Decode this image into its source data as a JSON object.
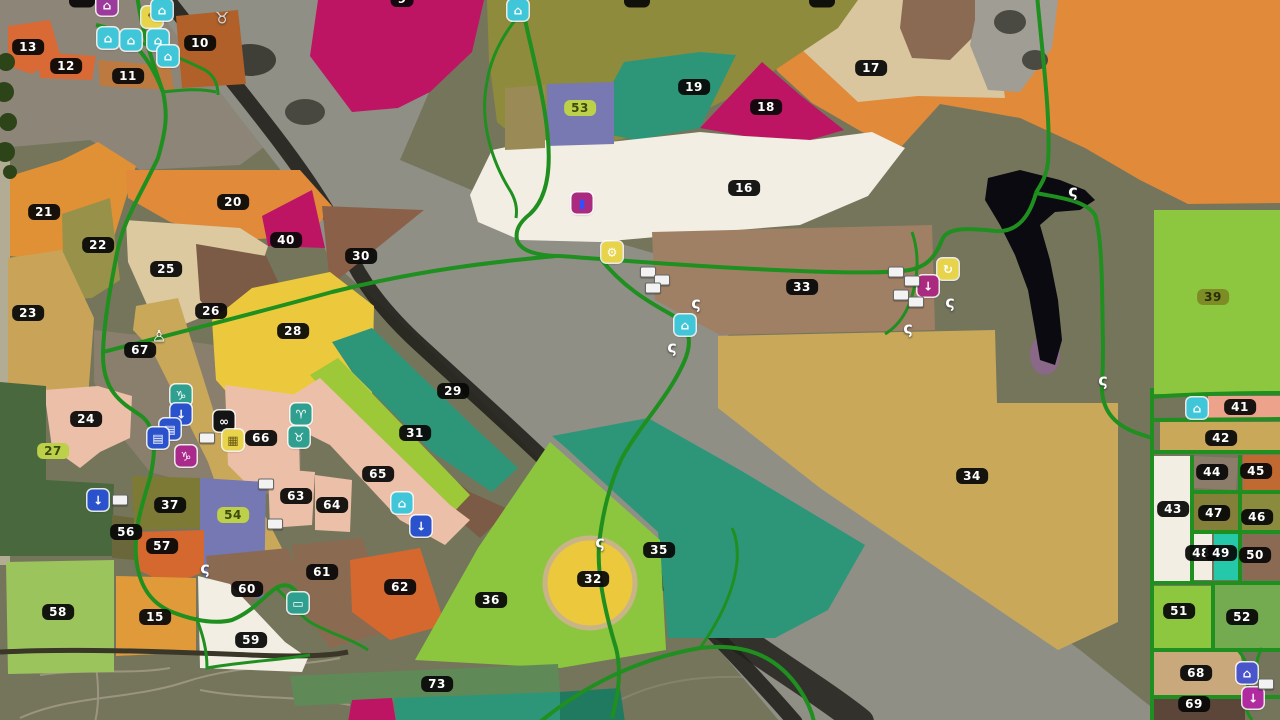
{
  "map": {
    "title": "farm-map-overview",
    "road_color": "#1f8f1f",
    "river_color": "#8f8f86",
    "river_dark_color": "#22211c",
    "lake_color": "#0a0a10",
    "terrain_color": "#75755c",
    "label_styles": {
      "dark": {
        "bg": "#0a0a0a",
        "fg": "#ffffff"
      },
      "green": {
        "bg": "#bdd04a",
        "fg": "#3c4a0c"
      },
      "olive": {
        "bg": "#7d8c24",
        "fg": "#272f08"
      }
    },
    "fields": [
      {
        "n": "9",
        "x": 402,
        "y": -1,
        "c": "#be1464"
      },
      {
        "n": "10",
        "x": 200,
        "y": 43,
        "c": "#b06028"
      },
      {
        "n": "11",
        "x": 128,
        "y": 76,
        "c": "#bd7a40"
      },
      {
        "n": "12",
        "x": 66,
        "y": 66,
        "c": "#d96a35"
      },
      {
        "n": "13",
        "x": 28,
        "y": 47,
        "c": "#d96a35"
      },
      {
        "n": "15",
        "x": 155,
        "y": 617,
        "c": "#e09a3a"
      },
      {
        "n": "16",
        "x": 744,
        "y": 188,
        "c": "#f2eee3"
      },
      {
        "n": "17",
        "x": 871,
        "y": 68,
        "c": "#e08a3a"
      },
      {
        "n": "18",
        "x": 766,
        "y": 107,
        "c": "#be1464"
      },
      {
        "n": "19",
        "x": 694,
        "y": 87,
        "c": "#2e9678"
      },
      {
        "n": "20",
        "x": 233,
        "y": 202,
        "c": "#e08a3a"
      },
      {
        "n": "21",
        "x": 44,
        "y": 212,
        "c": "#e09035"
      },
      {
        "n": "22",
        "x": 98,
        "y": 245,
        "c": "#97914a"
      },
      {
        "n": "23",
        "x": 28,
        "y": 313,
        "c": "#c9a458"
      },
      {
        "n": "24",
        "x": 86,
        "y": 419,
        "c": "#ecbfa8"
      },
      {
        "n": "25",
        "x": 166,
        "y": 269,
        "c": "#dcc9a0"
      },
      {
        "n": "26",
        "x": 211,
        "y": 311,
        "c": "#7b5a46"
      },
      {
        "n": "27",
        "x": 53,
        "y": 451,
        "c": "#4a683e",
        "s": "green"
      },
      {
        "n": "28",
        "x": 293,
        "y": 331,
        "c": "#ecc93c"
      },
      {
        "n": "29",
        "x": 453,
        "y": 391,
        "c": "#2e9678"
      },
      {
        "n": "30",
        "x": 361,
        "y": 256,
        "c": "#8a6148"
      },
      {
        "n": "31",
        "x": 415,
        "y": 433,
        "c": "#9dc838"
      },
      {
        "n": "32",
        "x": 593,
        "y": 579,
        "c": "#ecc93c"
      },
      {
        "n": "33",
        "x": 802,
        "y": 287,
        "c": "#a08065"
      },
      {
        "n": "34",
        "x": 972,
        "y": 476,
        "c": "#c9a85a"
      },
      {
        "n": "35",
        "x": 659,
        "y": 550,
        "c": "#2e9678"
      },
      {
        "n": "36",
        "x": 491,
        "y": 600,
        "c": "#8cc63f"
      },
      {
        "n": "37",
        "x": 170,
        "y": 505,
        "c": "#7d7a35"
      },
      {
        "n": "39",
        "x": 1213,
        "y": 297,
        "c": "#8dc63f",
        "s": "olive"
      },
      {
        "n": "40",
        "x": 286,
        "y": 240,
        "c": "#be1464"
      },
      {
        "n": "41",
        "x": 1240,
        "y": 407,
        "c": "#eda28c"
      },
      {
        "n": "42",
        "x": 1221,
        "y": 438,
        "c": "#c9a85a"
      },
      {
        "n": "43",
        "x": 1173,
        "y": 509,
        "c": "#f2eee3"
      },
      {
        "n": "44",
        "x": 1212,
        "y": 472,
        "c": "#8c7c6a"
      },
      {
        "n": "45",
        "x": 1256,
        "y": 471,
        "c": "#c06a32"
      },
      {
        "n": "46",
        "x": 1257,
        "y": 517,
        "c": "#8b8b3d"
      },
      {
        "n": "47",
        "x": 1214,
        "y": 513,
        "c": "#84803a"
      },
      {
        "n": "48",
        "x": 1201,
        "y": 553,
        "c": "#f2eee3"
      },
      {
        "n": "49",
        "x": 1221,
        "y": 553,
        "c": "#25c8a8"
      },
      {
        "n": "50",
        "x": 1255,
        "y": 555,
        "c": "#8a6a52"
      },
      {
        "n": "51",
        "x": 1179,
        "y": 611,
        "c": "#8dc63f"
      },
      {
        "n": "52",
        "x": 1242,
        "y": 617,
        "c": "#74ab50"
      },
      {
        "n": "53",
        "x": 580,
        "y": 108,
        "c": "#7878b2",
        "s": "green"
      },
      {
        "n": "54",
        "x": 233,
        "y": 515,
        "c": "#7578b2",
        "s": "green"
      },
      {
        "n": "56",
        "x": 126,
        "y": 532,
        "c": "#6a683a"
      },
      {
        "n": "57",
        "x": 162,
        "y": 546,
        "c": "#d4682f"
      },
      {
        "n": "58",
        "x": 58,
        "y": 612,
        "c": "#9cc45c"
      },
      {
        "n": "59",
        "x": 251,
        "y": 640,
        "c": "#f2eee3"
      },
      {
        "n": "60",
        "x": 247,
        "y": 589,
        "c": "#8b6a52"
      },
      {
        "n": "61",
        "x": 322,
        "y": 572,
        "c": "#8b6a52"
      },
      {
        "n": "62",
        "x": 400,
        "y": 587,
        "c": "#d4682f"
      },
      {
        "n": "63",
        "x": 296,
        "y": 496,
        "c": "#ecbfa8"
      },
      {
        "n": "64",
        "x": 332,
        "y": 505,
        "c": "#ecbfa8"
      },
      {
        "n": "65",
        "x": 378,
        "y": 474,
        "c": "#ecbfa8"
      },
      {
        "n": "66",
        "x": 261,
        "y": 438,
        "c": "#ecbfa8"
      },
      {
        "n": "67",
        "x": 140,
        "y": 350,
        "c": "#c9a85a"
      },
      {
        "n": "68",
        "x": 1196,
        "y": 673,
        "c": "#c9a87c"
      },
      {
        "n": "69",
        "x": 1194,
        "y": 704,
        "c": "#5c463a"
      },
      {
        "n": "73",
        "x": 437,
        "y": 684,
        "c": "#5f8a57"
      }
    ],
    "cut_labels": [
      {
        "x": 82,
        "y": 0,
        "t": ""
      },
      {
        "x": 637,
        "y": 0,
        "t": ""
      },
      {
        "x": 822,
        "y": 0,
        "t": ""
      }
    ],
    "icons": [
      {
        "name": "purple-building-icon",
        "k": "sq",
        "x": 107,
        "y": 5,
        "bg": "#9b3a9b",
        "fg": "#ffffff",
        "g": "⌂"
      },
      {
        "name": "notebook-icon",
        "k": "sq",
        "x": 152,
        "y": 17,
        "bg": "#e8d44a",
        "fg": "#5a4a10",
        "g": "✎"
      },
      {
        "name": "greenhouse-icon",
        "k": "sq",
        "x": 162,
        "y": 10,
        "bg": "#3fc6d9",
        "fg": "#ffffff",
        "g": "⌂"
      },
      {
        "name": "greenhouse-icon",
        "k": "sq",
        "x": 108,
        "y": 38,
        "bg": "#3fc6d9",
        "fg": "#ffffff",
        "g": "⌂"
      },
      {
        "name": "greenhouse-icon",
        "k": "sq",
        "x": 131,
        "y": 40,
        "bg": "#3fc6d9",
        "fg": "#ffffff",
        "g": "⌂"
      },
      {
        "name": "greenhouse-icon",
        "k": "sq",
        "x": 158,
        "y": 40,
        "bg": "#3fc6d9",
        "fg": "#ffffff",
        "g": "⌂"
      },
      {
        "name": "greenhouse-icon",
        "k": "sq",
        "x": 168,
        "y": 56,
        "bg": "#3fc6d9",
        "fg": "#ffffff",
        "g": "⌂"
      },
      {
        "name": "cow-icon",
        "k": "pin",
        "x": 222,
        "y": 18,
        "fg": "#d8d8d8",
        "g": "♉"
      },
      {
        "name": "greenhouse-icon",
        "k": "sq",
        "x": 518,
        "y": 10,
        "bg": "#3fc6d9",
        "fg": "#ffffff",
        "g": "⌂"
      },
      {
        "name": "fuel-station-icon",
        "k": "sq",
        "x": 582,
        "y": 203,
        "bg": "#aa2a80",
        "fg": "#3050ff",
        "g": "▮"
      },
      {
        "name": "workshop-icon",
        "k": "sq",
        "x": 612,
        "y": 252,
        "bg": "#e8d44a",
        "fg": "#ffffff",
        "g": "⚙"
      },
      {
        "name": "vehicle-icon",
        "k": "blob",
        "x": 648,
        "y": 272
      },
      {
        "name": "vehicle-icon",
        "k": "blob",
        "x": 662,
        "y": 280
      },
      {
        "name": "vehicle-icon",
        "k": "blob",
        "x": 653,
        "y": 288
      },
      {
        "name": "production-icon",
        "k": "sq",
        "x": 685,
        "y": 325,
        "bg": "#3fc6d9",
        "fg": "#ffffff",
        "g": "⌂"
      },
      {
        "name": "player-marker-icon",
        "k": "pin",
        "x": 696,
        "y": 303,
        "fg": "#ffffff",
        "g": "ς"
      },
      {
        "name": "player-marker-icon",
        "k": "pin",
        "x": 672,
        "y": 347,
        "fg": "#ffffff",
        "g": "ς"
      },
      {
        "name": "player-marker-icon",
        "k": "pin",
        "x": 1073,
        "y": 191,
        "fg": "#ffffff",
        "g": "ς"
      },
      {
        "name": "player-marker-icon",
        "k": "pin",
        "x": 1103,
        "y": 380,
        "fg": "#ffffff",
        "g": "ς"
      },
      {
        "name": "player-marker-icon",
        "k": "pin",
        "x": 205,
        "y": 568,
        "fg": "#ffffff",
        "g": "ς"
      },
      {
        "name": "player-marker-icon",
        "k": "pin",
        "x": 600,
        "y": 542,
        "fg": "#ffffff",
        "g": "ς"
      },
      {
        "name": "player-marker-icon",
        "k": "pin",
        "x": 950,
        "y": 302,
        "fg": "#ffffff",
        "g": "ς"
      },
      {
        "name": "player-marker-icon",
        "k": "pin",
        "x": 908,
        "y": 328,
        "fg": "#ffffff",
        "g": "ς"
      },
      {
        "name": "reset-icon",
        "k": "sq",
        "x": 948,
        "y": 269,
        "bg": "#e8d44a",
        "fg": "#ffffff",
        "g": "↻"
      },
      {
        "name": "harvester-icon",
        "k": "blob",
        "x": 896,
        "y": 272
      },
      {
        "name": "harvester-icon",
        "k": "blob",
        "x": 912,
        "y": 281
      },
      {
        "name": "harvester-icon",
        "k": "blob",
        "x": 901,
        "y": 295
      },
      {
        "name": "harvester-icon",
        "k": "blob",
        "x": 916,
        "y": 302
      },
      {
        "name": "sell-point-icon",
        "k": "sq",
        "x": 928,
        "y": 286,
        "bg": "#aa2a80",
        "fg": "#ffffff",
        "g": "↓"
      },
      {
        "name": "animal-pen-goat-icon",
        "k": "sq",
        "x": 181,
        "y": 395,
        "bg": "#2fa090",
        "fg": "#ffffff",
        "g": "♑"
      },
      {
        "name": "animal-pen-sheep-icon",
        "k": "sq",
        "x": 301,
        "y": 414,
        "bg": "#2fa090",
        "fg": "#ffffff",
        "g": "♈"
      },
      {
        "name": "animal-pen-cow-icon",
        "k": "sq",
        "x": 299,
        "y": 437,
        "bg": "#2fa090",
        "fg": "#ffffff",
        "g": "♉"
      },
      {
        "name": "delivery-point-icon",
        "k": "sq",
        "x": 181,
        "y": 414,
        "bg": "#2a52cc",
        "fg": "#ffffff",
        "g": "↓"
      },
      {
        "name": "delivery-point-icon",
        "k": "sq",
        "x": 170,
        "y": 429,
        "bg": "#2a52cc",
        "fg": "#ffffff",
        "g": "▤"
      },
      {
        "name": "delivery-point-icon",
        "k": "sq",
        "x": 158,
        "y": 438,
        "bg": "#2a52cc",
        "fg": "#ffffff",
        "g": "▤"
      },
      {
        "name": "binoculars-icon",
        "k": "sq",
        "x": 224,
        "y": 421,
        "bg": "#141414",
        "fg": "#ffffff",
        "g": "∞"
      },
      {
        "name": "bale-storage-icon",
        "k": "sq",
        "x": 233,
        "y": 440,
        "bg": "#e8d44a",
        "fg": "#6a5a14",
        "g": "▦"
      },
      {
        "name": "animal-dealer-icon",
        "k": "sq",
        "x": 186,
        "y": 456,
        "bg": "#aa2a8c",
        "fg": "#ffffff",
        "g": "♑"
      },
      {
        "name": "hen-icon",
        "k": "pin",
        "x": 159,
        "y": 336,
        "fg": "#ffffff",
        "g": "♙"
      },
      {
        "name": "vehicle-icon",
        "k": "blob",
        "x": 207,
        "y": 438
      },
      {
        "name": "vehicle-icon",
        "k": "blob",
        "x": 120,
        "y": 500
      },
      {
        "name": "vehicle-icon",
        "k": "blob",
        "x": 266,
        "y": 484
      },
      {
        "name": "vehicle-icon",
        "k": "blob",
        "x": 275,
        "y": 524
      },
      {
        "name": "delivery-point-icon",
        "k": "sq",
        "x": 98,
        "y": 500,
        "bg": "#2a52cc",
        "fg": "#ffffff",
        "g": "↓"
      },
      {
        "name": "greenhouse-icon",
        "k": "sq",
        "x": 402,
        "y": 503,
        "bg": "#3fc6d9",
        "fg": "#ffffff",
        "g": "⌂"
      },
      {
        "name": "delivery-point-icon",
        "k": "sq",
        "x": 421,
        "y": 526,
        "bg": "#2a52cc",
        "fg": "#ffffff",
        "g": "↓"
      },
      {
        "name": "tractor-station-icon",
        "k": "sq",
        "x": 298,
        "y": 603,
        "bg": "#2fa090",
        "fg": "#ffffff",
        "g": "▭"
      },
      {
        "name": "greenhouse-icon",
        "k": "sq",
        "x": 1197,
        "y": 408,
        "bg": "#3fc6d9",
        "fg": "#ffffff",
        "g": "⌂"
      },
      {
        "name": "water-station-icon",
        "k": "sq",
        "x": 1247,
        "y": 673,
        "bg": "#4a55cc",
        "fg": "#ffffff",
        "g": "⌂"
      },
      {
        "name": "harvester-icon",
        "k": "blob",
        "x": 1266,
        "y": 684
      },
      {
        "name": "unload-point-icon",
        "k": "sq",
        "x": 1253,
        "y": 698,
        "bg": "#b02aa0",
        "fg": "#ffffff",
        "g": "↓"
      }
    ]
  }
}
